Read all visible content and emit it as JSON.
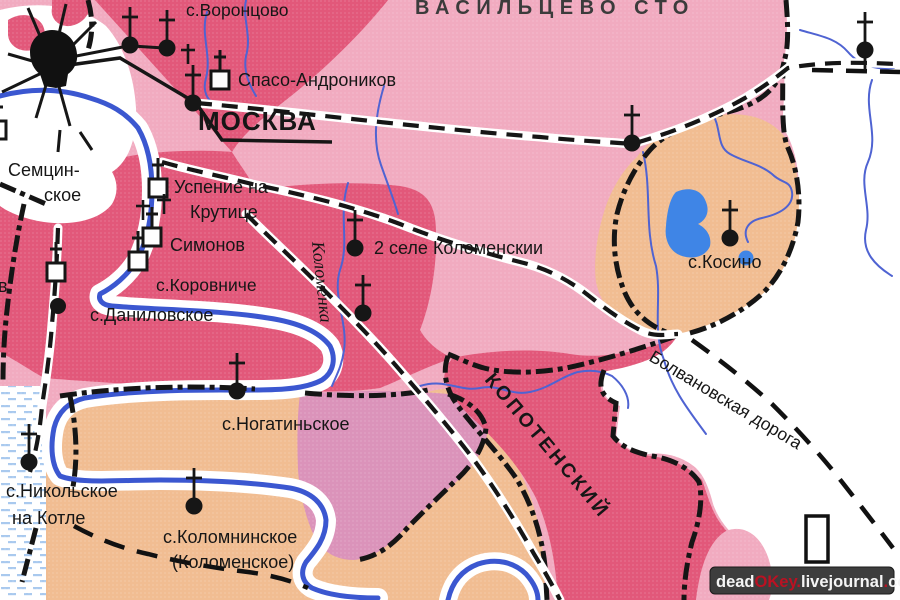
{
  "map": {
    "region_title": "ВАСИЛЬЦЕВО СТО",
    "district_label": "КОПОТЕНСКИЙ",
    "river_label": "Коломенка",
    "road_label": "Болвановская дорога",
    "edge_label": "в",
    "places": {
      "vorontsovo": "с.Воронцово",
      "spaso_andronikov": "Спасо-Андроников",
      "moskva": "МОСКВА",
      "semtsin1": "Семцин-",
      "semtsin2": "ское",
      "uspenie1": "Успение на",
      "uspenie2": "Крутице",
      "simonov": "Симонов",
      "korovniche": "с.Коровниче",
      "danilovskoe": "с.Даниловское",
      "sele_kolomenskii": "2 селе Коломенскии",
      "kosino": "с.Косино",
      "nogatinskoe": "с.Ногатиньское",
      "nikolskoe1": "с.Никольское",
      "nikolskoe2": "на Котле",
      "kolomninskoe1": "с.Коломнинское",
      "kolomninskoe2": "(Коломенское)"
    },
    "watermark": {
      "p1": "dead",
      "p2": "OKey",
      "p3": ".",
      "p4": "livejournal",
      "p5": ".",
      "p6": "com"
    },
    "colors": {
      "light_pink": "#f1abc0",
      "dark_pink": "#e2587a",
      "mauve": "#db93ba",
      "tan": "#f1bd92",
      "white_area": "#ffffff",
      "river_blue": "#3b57d0",
      "stream_blue": "#4f63d2",
      "lake_blue": "#3f85e6",
      "marsh_blue": "#a9c9ee",
      "line_black": "#161616",
      "district_text": "#2e1a18",
      "watermark_bg": "#3d3d3d",
      "watermark_red": "#bb1122"
    }
  }
}
